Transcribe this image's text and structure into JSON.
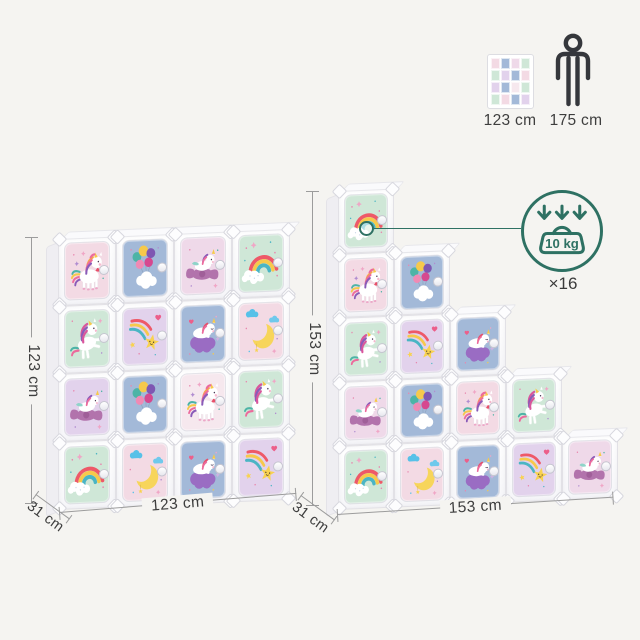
{
  "scale": {
    "unit_thumb_label": "123 cm",
    "person_label": "175 cm"
  },
  "load": {
    "weight": "10 kg",
    "multiplier": "×16"
  },
  "units": {
    "left": {
      "height": "123 cm",
      "width": "123 cm",
      "depth": "31 cm",
      "grid": "4x4",
      "rows": [
        [
          {
            "motif": "unicorn-standing",
            "bg": "pink"
          },
          {
            "motif": "balloons",
            "bg": "blue"
          },
          {
            "motif": "unicorn-cloud",
            "bg": "roselilac"
          },
          {
            "motif": "rainbow",
            "bg": "mint"
          }
        ],
        [
          {
            "motif": "unicorn-prancing",
            "bg": "mint"
          },
          {
            "motif": "shooting-star",
            "bg": "lilac"
          },
          {
            "motif": "unicorn-sleeping",
            "bg": "blue"
          },
          {
            "motif": "moon",
            "bg": "pink"
          }
        ],
        [
          {
            "motif": "unicorn-cloud",
            "bg": "lilac"
          },
          {
            "motif": "balloons",
            "bg": "blue"
          },
          {
            "motif": "unicorn-standing",
            "bg": "pale"
          },
          {
            "motif": "unicorn-prancing",
            "bg": "mint"
          }
        ],
        [
          {
            "motif": "rainbow",
            "bg": "mint"
          },
          {
            "motif": "moon",
            "bg": "pink"
          },
          {
            "motif": "unicorn-sleeping",
            "bg": "blue"
          },
          {
            "motif": "shooting-star",
            "bg": "lilac"
          }
        ]
      ]
    },
    "right": {
      "height": "153 cm",
      "width": "153 cm",
      "depth": "31 cm",
      "layout": "staircase-5-4-3-2-1",
      "columns": [
        [
          {
            "motif": "rainbow",
            "bg": "mint"
          },
          {
            "motif": "unicorn-standing",
            "bg": "pink"
          },
          {
            "motif": "unicorn-prancing",
            "bg": "mint"
          },
          {
            "motif": "unicorn-cloud",
            "bg": "roselilac"
          },
          {
            "motif": "rainbow",
            "bg": "mint"
          }
        ],
        [
          {
            "motif": "balloons",
            "bg": "blue"
          },
          {
            "motif": "shooting-star",
            "bg": "lilac"
          },
          {
            "motif": "balloons",
            "bg": "blue"
          },
          {
            "motif": "moon",
            "bg": "pink"
          }
        ],
        [
          {
            "motif": "unicorn-sleeping",
            "bg": "blue"
          },
          {
            "motif": "unicorn-standing",
            "bg": "pink"
          },
          {
            "motif": "unicorn-sleeping",
            "bg": "blue"
          }
        ],
        [
          {
            "motif": "unicorn-prancing",
            "bg": "mint"
          },
          {
            "motif": "shooting-star",
            "bg": "lilac"
          }
        ],
        [
          {
            "motif": "unicorn-cloud",
            "bg": "roselilac"
          }
        ]
      ]
    }
  },
  "palette": {
    "background": "#f5f4f1",
    "pink": "#f3dae4",
    "blue": "#a3b9d8",
    "mint": "#cfe7d7",
    "lilac": "#e2d2ec",
    "roselilac": "#efd9e9",
    "pale": "#f6e8ee",
    "accent_teal": "#2e7163",
    "dim_line": "#9c9c9c",
    "text": "#3e3e3e"
  }
}
